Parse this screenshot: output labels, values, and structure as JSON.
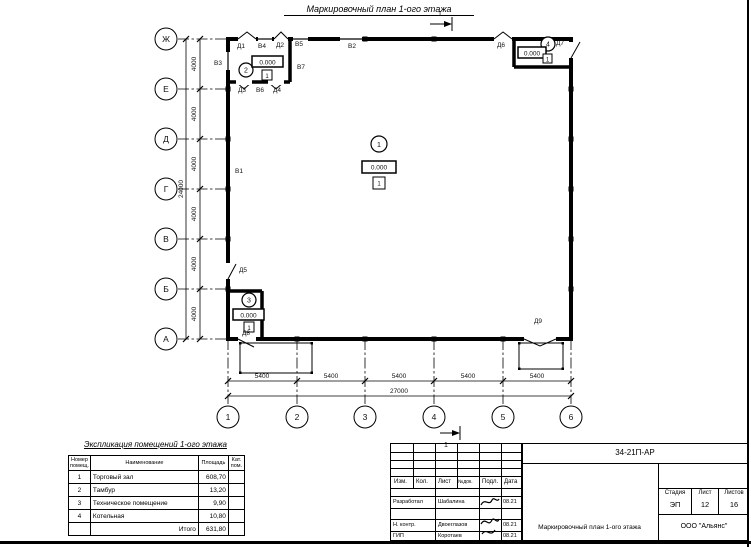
{
  "page_title": "Маркировочный план 1-ого этажа",
  "plan": {
    "row_axes": [
      "Ж",
      "Е",
      "Д",
      "Г",
      "В",
      "Б",
      "А"
    ],
    "col_axes": [
      "1",
      "2",
      "3",
      "4",
      "5",
      "6"
    ],
    "dims": {
      "bay_v": "4000",
      "total_v": "24000",
      "bay_h": "5400",
      "total_h": "27000"
    },
    "elevation": "0.000",
    "floor_mark": "1",
    "room_numbers": [
      "1",
      "2",
      "3",
      "4"
    ],
    "section_mark": "1",
    "marks": {
      "v1": "В1",
      "v2": "В2",
      "v3": "В3",
      "v4": "В4",
      "v5": "В5",
      "v6": "В6",
      "v7": "В7",
      "d1": "Д1",
      "d2": "Д2",
      "d3": "Д3",
      "d4": "Д4",
      "d5": "Д5",
      "d6": "Д6",
      "d7": "Д7",
      "d8": "Д8",
      "d9": "Д9"
    }
  },
  "explication": {
    "title": "Экспликация помещений 1-ого этажа",
    "headers": [
      "Номер помещ.",
      "Наименование",
      "Площадь",
      "Кат. пом."
    ],
    "rows": [
      {
        "num": "1",
        "name": "Торговый зал",
        "area": "608,70",
        "cat": ""
      },
      {
        "num": "2",
        "name": "Тамбур",
        "area": "13,20",
        "cat": ""
      },
      {
        "num": "3",
        "name": "Техническое помещение",
        "area": "9,90",
        "cat": ""
      },
      {
        "num": "4",
        "name": "Котельная",
        "area": "10,80",
        "cat": ""
      }
    ],
    "total_label": "Итого",
    "total_area": "631,80"
  },
  "titleblock": {
    "doc_code": "34-21П-АР",
    "columns": [
      "Изм.",
      "Кол.",
      "Лист",
      "№док.",
      "Подл.",
      "Дата"
    ],
    "rows": [
      {
        "role": "Разработал",
        "name": "Шабалина",
        "date": "08.21"
      },
      {
        "role": "Н. контр.",
        "name": "Двоеглазов",
        "date": "08.21"
      },
      {
        "role": "ГИП",
        "name": "Коротаев",
        "date": "08.21"
      }
    ],
    "stage_label": "Стадия",
    "sheet_label": "Лист",
    "sheets_label": "Листов",
    "stage": "ЭП",
    "sheet": "12",
    "sheets": "16",
    "drawing_title": "Маркировочный план 1-ого этажа",
    "company": "ООО \"Альянс\""
  }
}
